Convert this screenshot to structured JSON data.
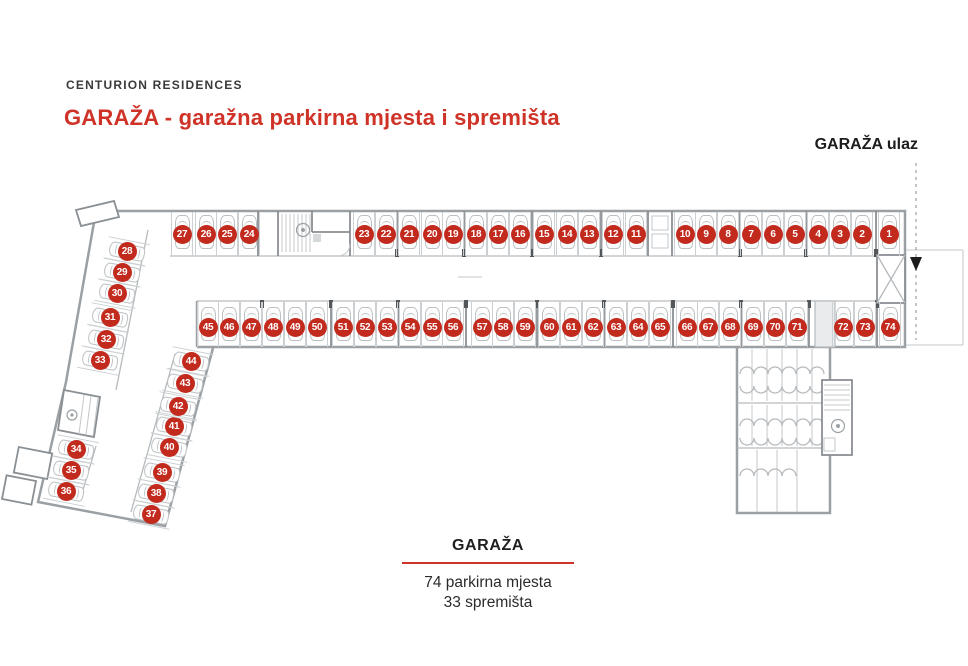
{
  "header": {
    "brand": "CENTURION RESIDENCES",
    "title": "GARAŽA - garažna parkirna mjesta i spremišta",
    "entrance_label": "GARAŽA ulaz"
  },
  "footer": {
    "title": "GARAŽA",
    "stat1": "74 parkirna mjesta",
    "stat2": "33 spremišta"
  },
  "colors": {
    "title_red": "#cf3328",
    "badge_red": "#c32a1e"
  },
  "spots": [
    {
      "n": 1,
      "x": 889,
      "y": 234,
      "t": "top"
    },
    {
      "n": 2,
      "x": 862,
      "y": 234,
      "t": "top"
    },
    {
      "n": 3,
      "x": 840,
      "y": 234,
      "t": "top"
    },
    {
      "n": 4,
      "x": 818,
      "y": 234,
      "t": "top"
    },
    {
      "n": 5,
      "x": 795,
      "y": 234,
      "t": "top"
    },
    {
      "n": 6,
      "x": 773,
      "y": 234,
      "t": "top"
    },
    {
      "n": 7,
      "x": 751,
      "y": 234,
      "t": "top"
    },
    {
      "n": 8,
      "x": 728,
      "y": 234,
      "t": "top"
    },
    {
      "n": 9,
      "x": 706,
      "y": 234,
      "t": "top"
    },
    {
      "n": 10,
      "x": 685,
      "y": 234,
      "t": "top"
    },
    {
      "n": 11,
      "x": 636,
      "y": 234,
      "t": "top"
    },
    {
      "n": 12,
      "x": 613,
      "y": 234,
      "t": "top"
    },
    {
      "n": 13,
      "x": 589,
      "y": 234,
      "t": "top"
    },
    {
      "n": 14,
      "x": 567,
      "y": 234,
      "t": "top"
    },
    {
      "n": 15,
      "x": 544,
      "y": 234,
      "t": "top"
    },
    {
      "n": 16,
      "x": 520,
      "y": 234,
      "t": "top"
    },
    {
      "n": 17,
      "x": 498,
      "y": 234,
      "t": "top"
    },
    {
      "n": 18,
      "x": 476,
      "y": 234,
      "t": "top"
    },
    {
      "n": 19,
      "x": 453,
      "y": 234,
      "t": "top"
    },
    {
      "n": 20,
      "x": 432,
      "y": 234,
      "t": "top"
    },
    {
      "n": 21,
      "x": 409,
      "y": 234,
      "t": "top"
    },
    {
      "n": 22,
      "x": 386,
      "y": 234,
      "t": "top"
    },
    {
      "n": 23,
      "x": 364,
      "y": 234,
      "t": "top"
    },
    {
      "n": 24,
      "x": 249,
      "y": 234,
      "t": "top"
    },
    {
      "n": 25,
      "x": 227,
      "y": 234,
      "t": "top"
    },
    {
      "n": 26,
      "x": 206,
      "y": 234,
      "t": "top"
    },
    {
      "n": 27,
      "x": 182,
      "y": 234,
      "t": "top"
    },
    {
      "n": 28,
      "x": 127,
      "y": 251,
      "t": "wing"
    },
    {
      "n": 29,
      "x": 122,
      "y": 272,
      "t": "wing"
    },
    {
      "n": 30,
      "x": 117,
      "y": 293,
      "t": "wing"
    },
    {
      "n": 31,
      "x": 110,
      "y": 317,
      "t": "wing"
    },
    {
      "n": 32,
      "x": 106,
      "y": 339,
      "t": "wing"
    },
    {
      "n": 33,
      "x": 100,
      "y": 360,
      "t": "wing"
    },
    {
      "n": 34,
      "x": 76,
      "y": 449,
      "t": "wing"
    },
    {
      "n": 35,
      "x": 71,
      "y": 470,
      "t": "wing"
    },
    {
      "n": 36,
      "x": 66,
      "y": 491,
      "t": "wing"
    },
    {
      "n": 37,
      "x": 151,
      "y": 514,
      "t": "wing"
    },
    {
      "n": 38,
      "x": 156,
      "y": 493,
      "t": "wing"
    },
    {
      "n": 39,
      "x": 162,
      "y": 472,
      "t": "wing"
    },
    {
      "n": 40,
      "x": 169,
      "y": 447,
      "t": "wing"
    },
    {
      "n": 41,
      "x": 174,
      "y": 426,
      "t": "wing"
    },
    {
      "n": 42,
      "x": 178,
      "y": 406,
      "t": "wing"
    },
    {
      "n": 43,
      "x": 185,
      "y": 383,
      "t": "wing"
    },
    {
      "n": 44,
      "x": 191,
      "y": 361,
      "t": "wing"
    },
    {
      "n": 45,
      "x": 208,
      "y": 327,
      "t": "mid"
    },
    {
      "n": 46,
      "x": 229,
      "y": 327,
      "t": "mid"
    },
    {
      "n": 47,
      "x": 251,
      "y": 327,
      "t": "mid"
    },
    {
      "n": 48,
      "x": 273,
      "y": 327,
      "t": "mid"
    },
    {
      "n": 49,
      "x": 295,
      "y": 327,
      "t": "mid"
    },
    {
      "n": 50,
      "x": 317,
      "y": 327,
      "t": "mid"
    },
    {
      "n": 51,
      "x": 343,
      "y": 327,
      "t": "mid"
    },
    {
      "n": 52,
      "x": 365,
      "y": 327,
      "t": "mid"
    },
    {
      "n": 53,
      "x": 387,
      "y": 327,
      "t": "mid"
    },
    {
      "n": 54,
      "x": 410,
      "y": 327,
      "t": "mid"
    },
    {
      "n": 55,
      "x": 432,
      "y": 327,
      "t": "mid"
    },
    {
      "n": 56,
      "x": 453,
      "y": 327,
      "t": "mid"
    },
    {
      "n": 57,
      "x": 482,
      "y": 327,
      "t": "mid"
    },
    {
      "n": 58,
      "x": 503,
      "y": 327,
      "t": "mid"
    },
    {
      "n": 59,
      "x": 525,
      "y": 327,
      "t": "mid"
    },
    {
      "n": 60,
      "x": 549,
      "y": 327,
      "t": "mid"
    },
    {
      "n": 61,
      "x": 571,
      "y": 327,
      "t": "mid"
    },
    {
      "n": 62,
      "x": 593,
      "y": 327,
      "t": "mid"
    },
    {
      "n": 63,
      "x": 616,
      "y": 327,
      "t": "mid"
    },
    {
      "n": 64,
      "x": 638,
      "y": 327,
      "t": "mid"
    },
    {
      "n": 65,
      "x": 660,
      "y": 327,
      "t": "mid"
    },
    {
      "n": 66,
      "x": 687,
      "y": 327,
      "t": "mid"
    },
    {
      "n": 67,
      "x": 708,
      "y": 327,
      "t": "mid"
    },
    {
      "n": 68,
      "x": 730,
      "y": 327,
      "t": "mid"
    },
    {
      "n": 69,
      "x": 753,
      "y": 327,
      "t": "mid"
    },
    {
      "n": 70,
      "x": 775,
      "y": 327,
      "t": "mid"
    },
    {
      "n": 71,
      "x": 797,
      "y": 327,
      "t": "mid"
    },
    {
      "n": 72,
      "x": 843,
      "y": 327,
      "t": "mid"
    },
    {
      "n": 73,
      "x": 865,
      "y": 327,
      "t": "mid"
    },
    {
      "n": 74,
      "x": 890,
      "y": 327,
      "t": "mid"
    }
  ]
}
